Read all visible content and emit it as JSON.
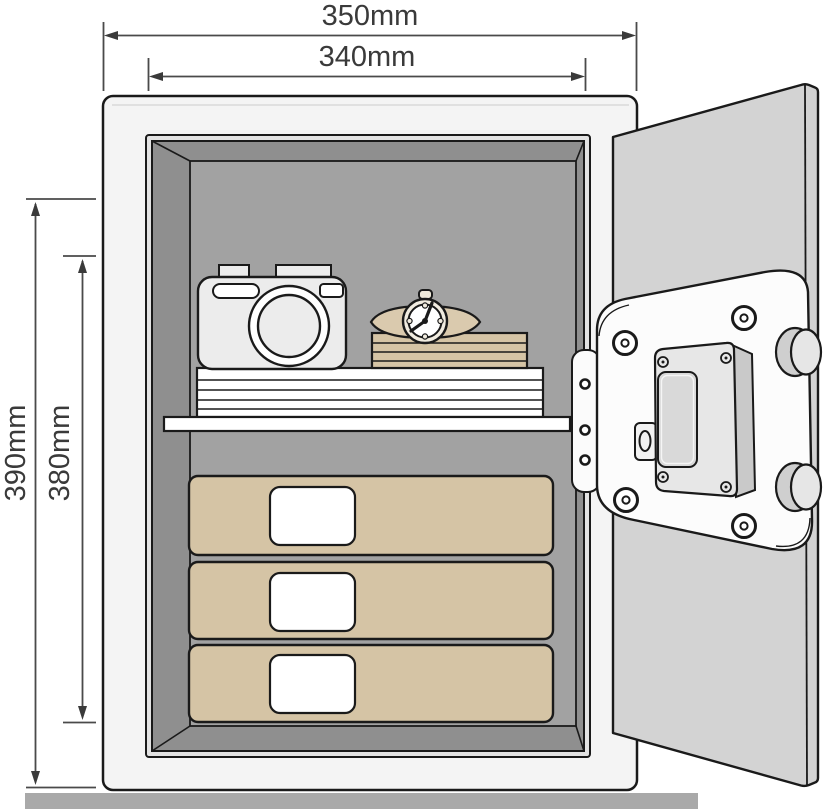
{
  "diagram": {
    "title": "safe-dimension-diagram",
    "dimensions": {
      "outer_width": "350mm",
      "inner_width": "340mm",
      "outer_height": "390mm",
      "inner_height": "380mm"
    },
    "colors": {
      "outline": "#1a1a1a",
      "dimension_line": "#4a4a4a",
      "dimension_text": "#3a3a3a",
      "safe_body": "#f4f4f4",
      "door": "#d3d3d3",
      "opening_bezel": "#e3e3e3",
      "interior_wall": "#8f8f8f",
      "interior_back": "#a2a2a2",
      "tan_items": "#d5c4a5",
      "white_items": "#ffffff",
      "floor": "#a9a9a9"
    }
  }
}
